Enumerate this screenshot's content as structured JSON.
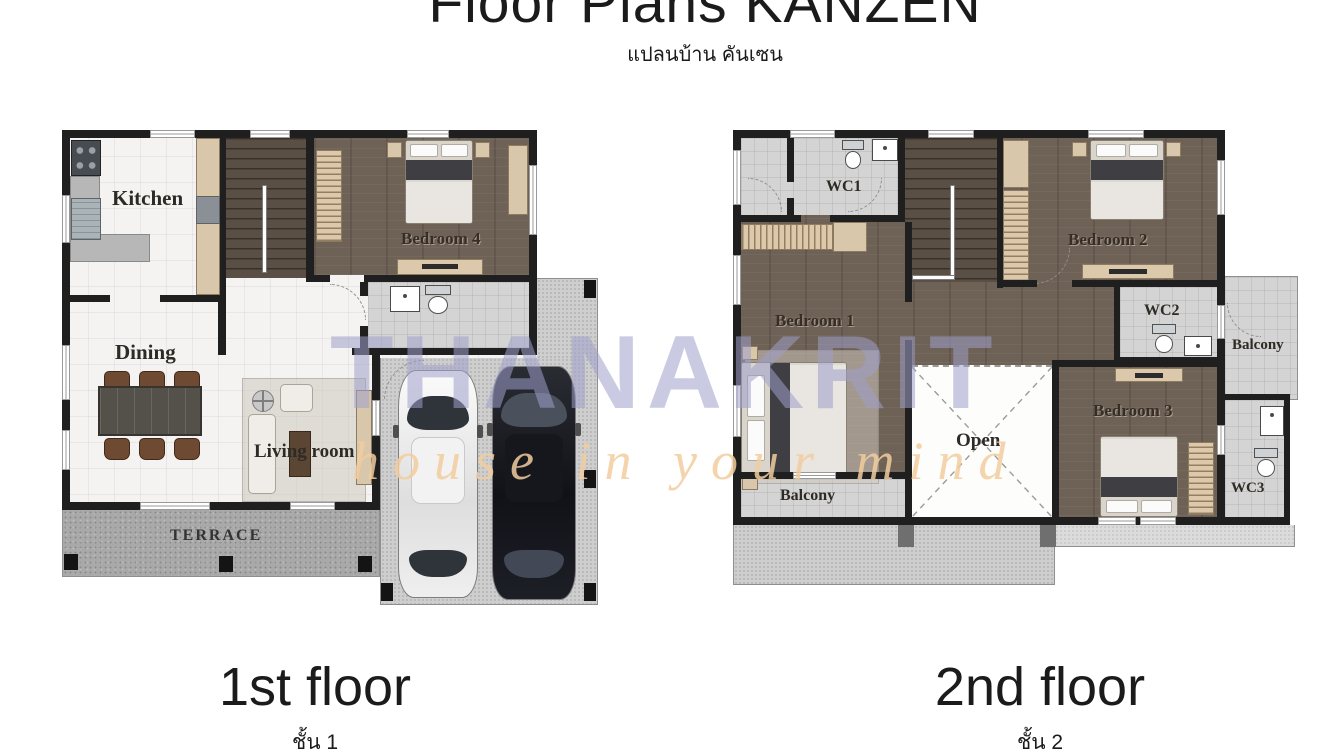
{
  "header": {
    "title": "Floor Plans KANZEN",
    "subtitle_thai": "แปลนบ้าน คันเซน"
  },
  "watermark": {
    "brand": "THANAKRIT",
    "tagline": "house in your mind",
    "brand_color": "#9e9ecb",
    "tagline_color": "#f2cd9e"
  },
  "floor1": {
    "caption": "1st floor",
    "caption_thai": "ชั้น 1",
    "rooms": {
      "kitchen": "Kitchen",
      "dining": "Dining",
      "living": "Living room",
      "terrace": "TERRACE",
      "bedroom4": "Bedroom 4"
    }
  },
  "floor2": {
    "caption": "2nd floor",
    "caption_thai": "ชั้น 2",
    "rooms": {
      "wc1": "WC1",
      "bedroom1": "Bedroom 1",
      "bedroom2": "Bedroom 2",
      "wc2": "WC2",
      "balcony_side": "Balcony",
      "bedroom3": "Bedroom 3",
      "wc3": "WC3",
      "open": "Open",
      "balcony_front": "Balcony"
    }
  },
  "colors": {
    "wall": "#1f1f1f",
    "wood_floor": "#6e6156",
    "tile_light": "#f4f3f1",
    "tile_gray": "#d4d4d4",
    "concrete": "#cecece",
    "terrace_concrete": "#a9a9a9",
    "cabinet_tan": "#d9c7ab"
  }
}
